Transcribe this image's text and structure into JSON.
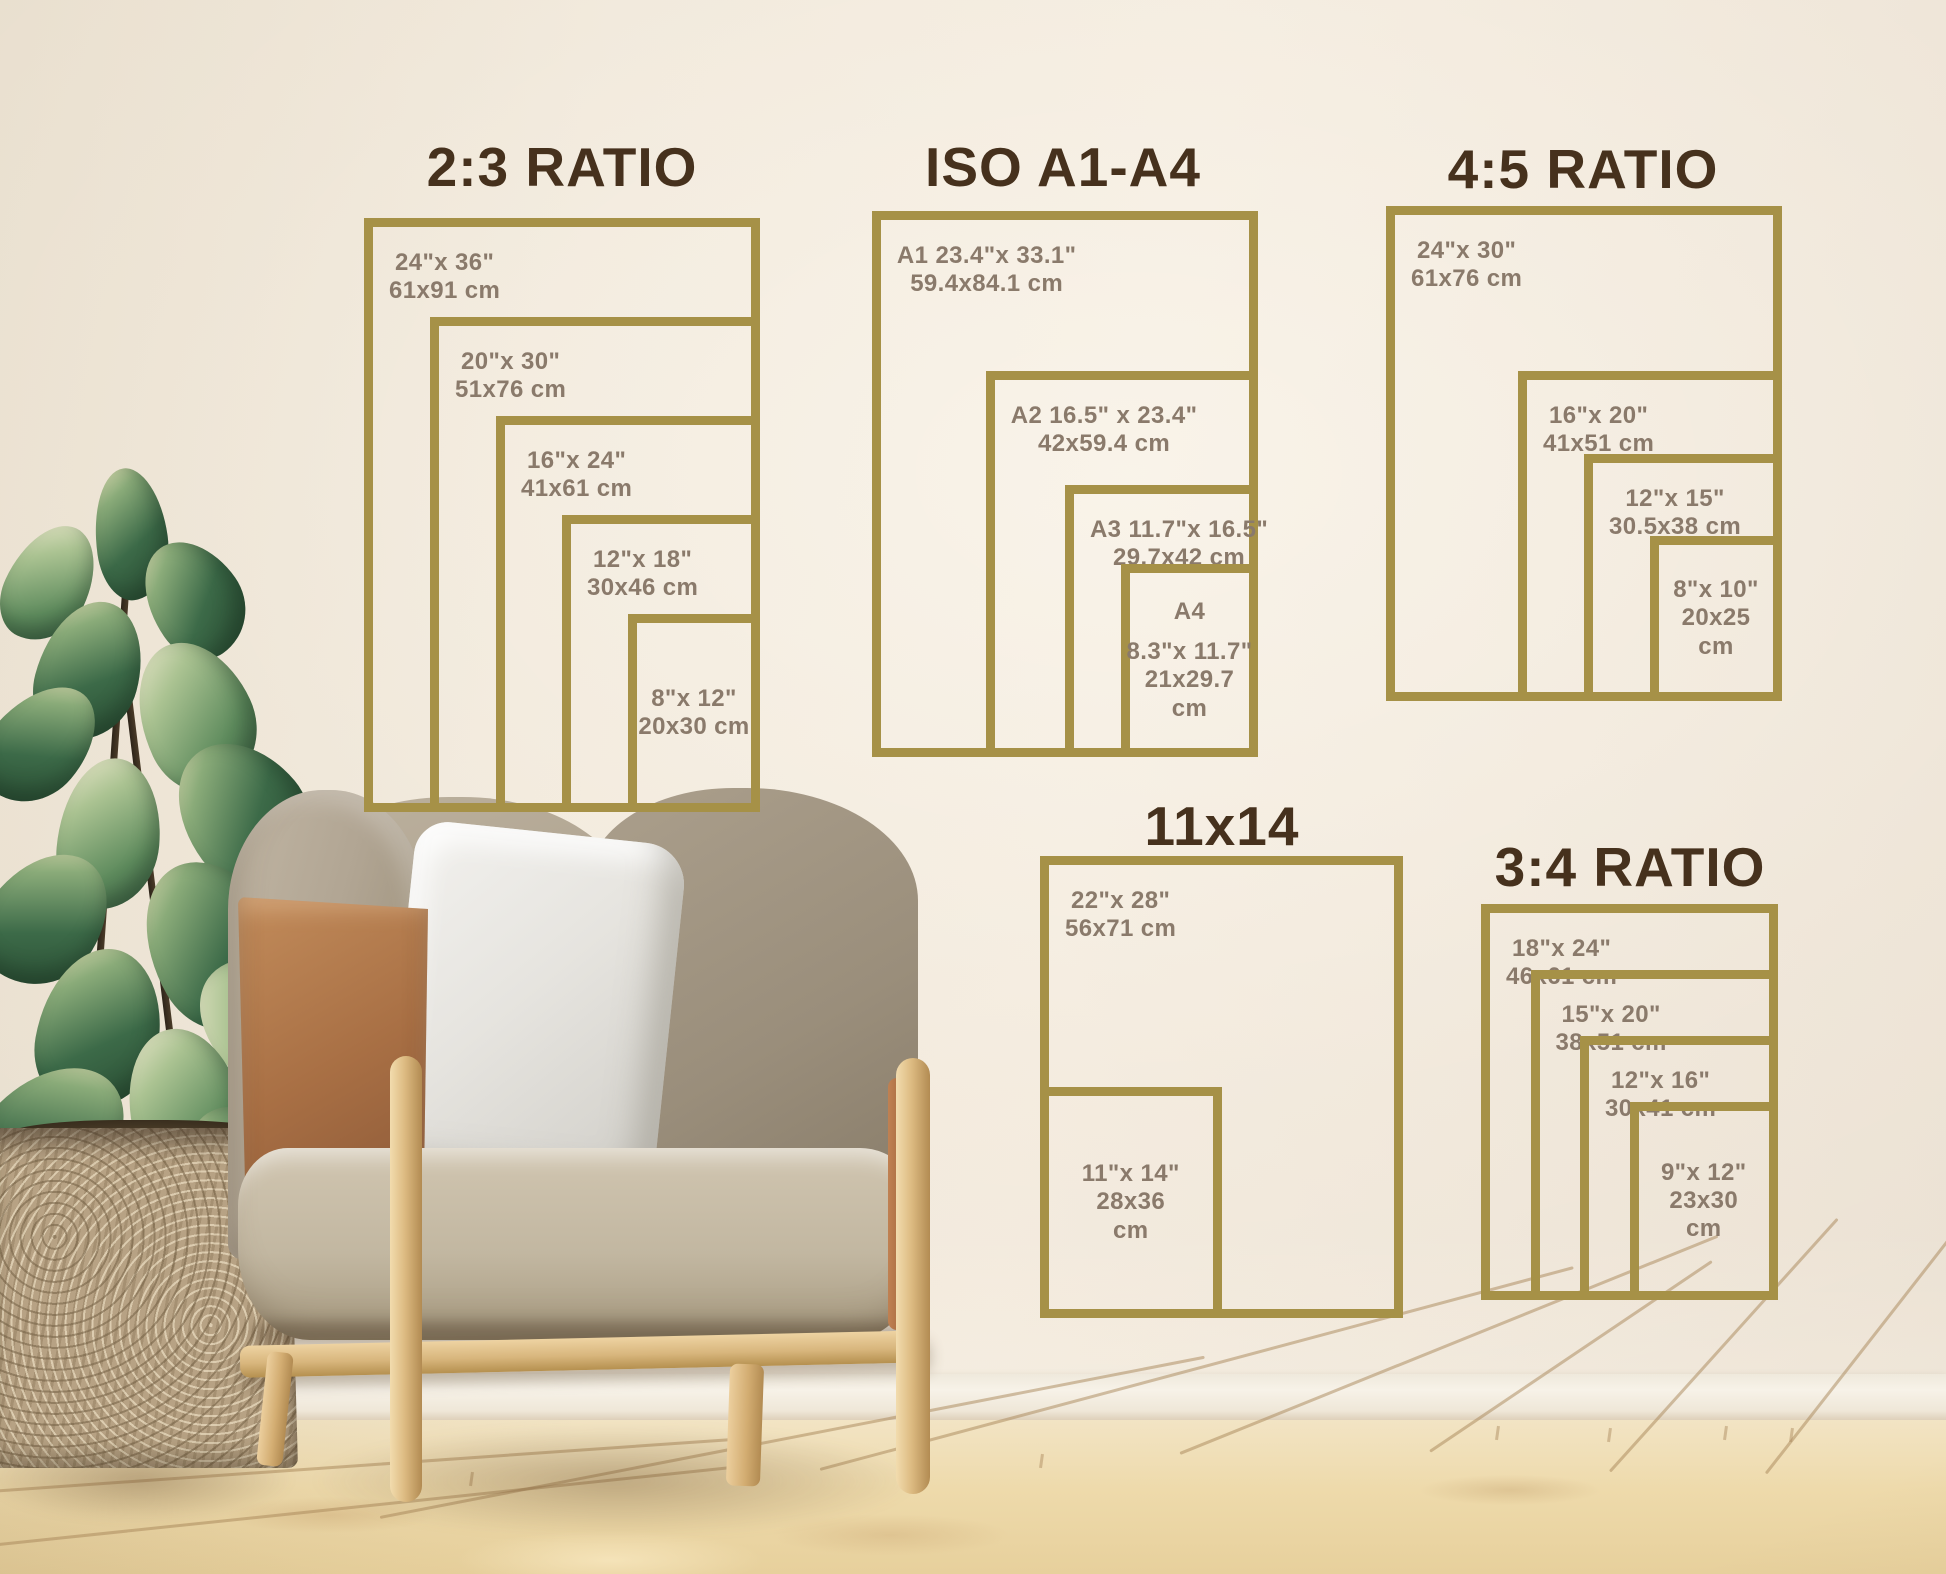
{
  "palette": {
    "wall": "#ece3d6",
    "frame_gold": "#a69147",
    "title_brown": "#46311d",
    "label_taupe": "#8a7a6b",
    "floor_wood": "#eedaab",
    "baseboard": "#f6f1e7",
    "leather": "#a86f44",
    "fabric": "#b1a693",
    "pillow": "#e6e4df",
    "wood": "#ddbb82",
    "basket": "#b7a284",
    "leaf_dark": "#34603f",
    "leaf_light": "#d9d3a9"
  },
  "groups": [
    {
      "id": "ratio-2-3",
      "title": "2:3 RATIO",
      "sizes": [
        {
          "w_in": 24,
          "h_in": 36,
          "lines": [
            "24\"x 36\"",
            "61x91 cm"
          ]
        },
        {
          "w_in": 20,
          "h_in": 30,
          "lines": [
            "20\"x 30\"",
            "51x76 cm"
          ]
        },
        {
          "w_in": 16,
          "h_in": 24,
          "lines": [
            "16\"x 24\"",
            "41x61 cm"
          ]
        },
        {
          "w_in": 12,
          "h_in": 18,
          "lines": [
            "12\"x 18\"",
            "30x46 cm"
          ]
        },
        {
          "w_in": 8,
          "h_in": 12,
          "lines": [
            "8\"x 12\"",
            "20x30 cm"
          ]
        }
      ]
    },
    {
      "id": "iso-a1-a4",
      "title": "ISO A1-A4",
      "sizes": [
        {
          "w_in": 23.4,
          "h_in": 33.1,
          "lines": [
            "A1 23.4\"x 33.1\"",
            "59.4x84.1 cm"
          ]
        },
        {
          "w_in": 16.5,
          "h_in": 23.4,
          "lines": [
            "A2 16.5\" x 23.4\"",
            "42x59.4 cm"
          ]
        },
        {
          "w_in": 11.7,
          "h_in": 16.5,
          "lines": [
            "A3 11.7\"x 16.5\"",
            "29.7x42 cm"
          ]
        },
        {
          "w_in": 8.3,
          "h_in": 11.7,
          "lines": [
            "A4",
            "8.3\"x 11.7\"",
            "21x29.7",
            "cm"
          ]
        }
      ]
    },
    {
      "id": "ratio-4-5",
      "title": "4:5 RATIO",
      "sizes": [
        {
          "w_in": 24,
          "h_in": 30,
          "lines": [
            "24\"x 30\"",
            "61x76 cm"
          ]
        },
        {
          "w_in": 16,
          "h_in": 20,
          "lines": [
            "16\"x 20\"",
            "41x51 cm"
          ]
        },
        {
          "w_in": 12,
          "h_in": 15,
          "lines": [
            "12\"x 15\"",
            "30.5x38 cm"
          ]
        },
        {
          "w_in": 8,
          "h_in": 10,
          "lines": [
            "8\"x 10\"",
            "20x25",
            "cm"
          ]
        }
      ]
    },
    {
      "id": "size-11x14",
      "title": "11x14",
      "sizes": [
        {
          "w_in": 22,
          "h_in": 28,
          "lines": [
            "22\"x 28\"",
            "56x71 cm"
          ]
        },
        {
          "w_in": 11,
          "h_in": 14,
          "lines": [
            "11\"x 14\"",
            "28x36",
            "cm"
          ]
        }
      ]
    },
    {
      "id": "ratio-3-4",
      "title": "3:4 RATIO",
      "sizes": [
        {
          "w_in": 18,
          "h_in": 24,
          "lines": [
            "18\"x 24\"",
            "46x61 cm"
          ]
        },
        {
          "w_in": 15,
          "h_in": 20,
          "lines": [
            "15\"x 20\"",
            "38x51 cm"
          ]
        },
        {
          "w_in": 12,
          "h_in": 16,
          "lines": [
            "12\"x 16\"",
            "30x41 cm"
          ]
        },
        {
          "w_in": 9,
          "h_in": 12,
          "lines": [
            "9\"x 12\"",
            "23x30",
            "cm"
          ]
        }
      ]
    }
  ]
}
